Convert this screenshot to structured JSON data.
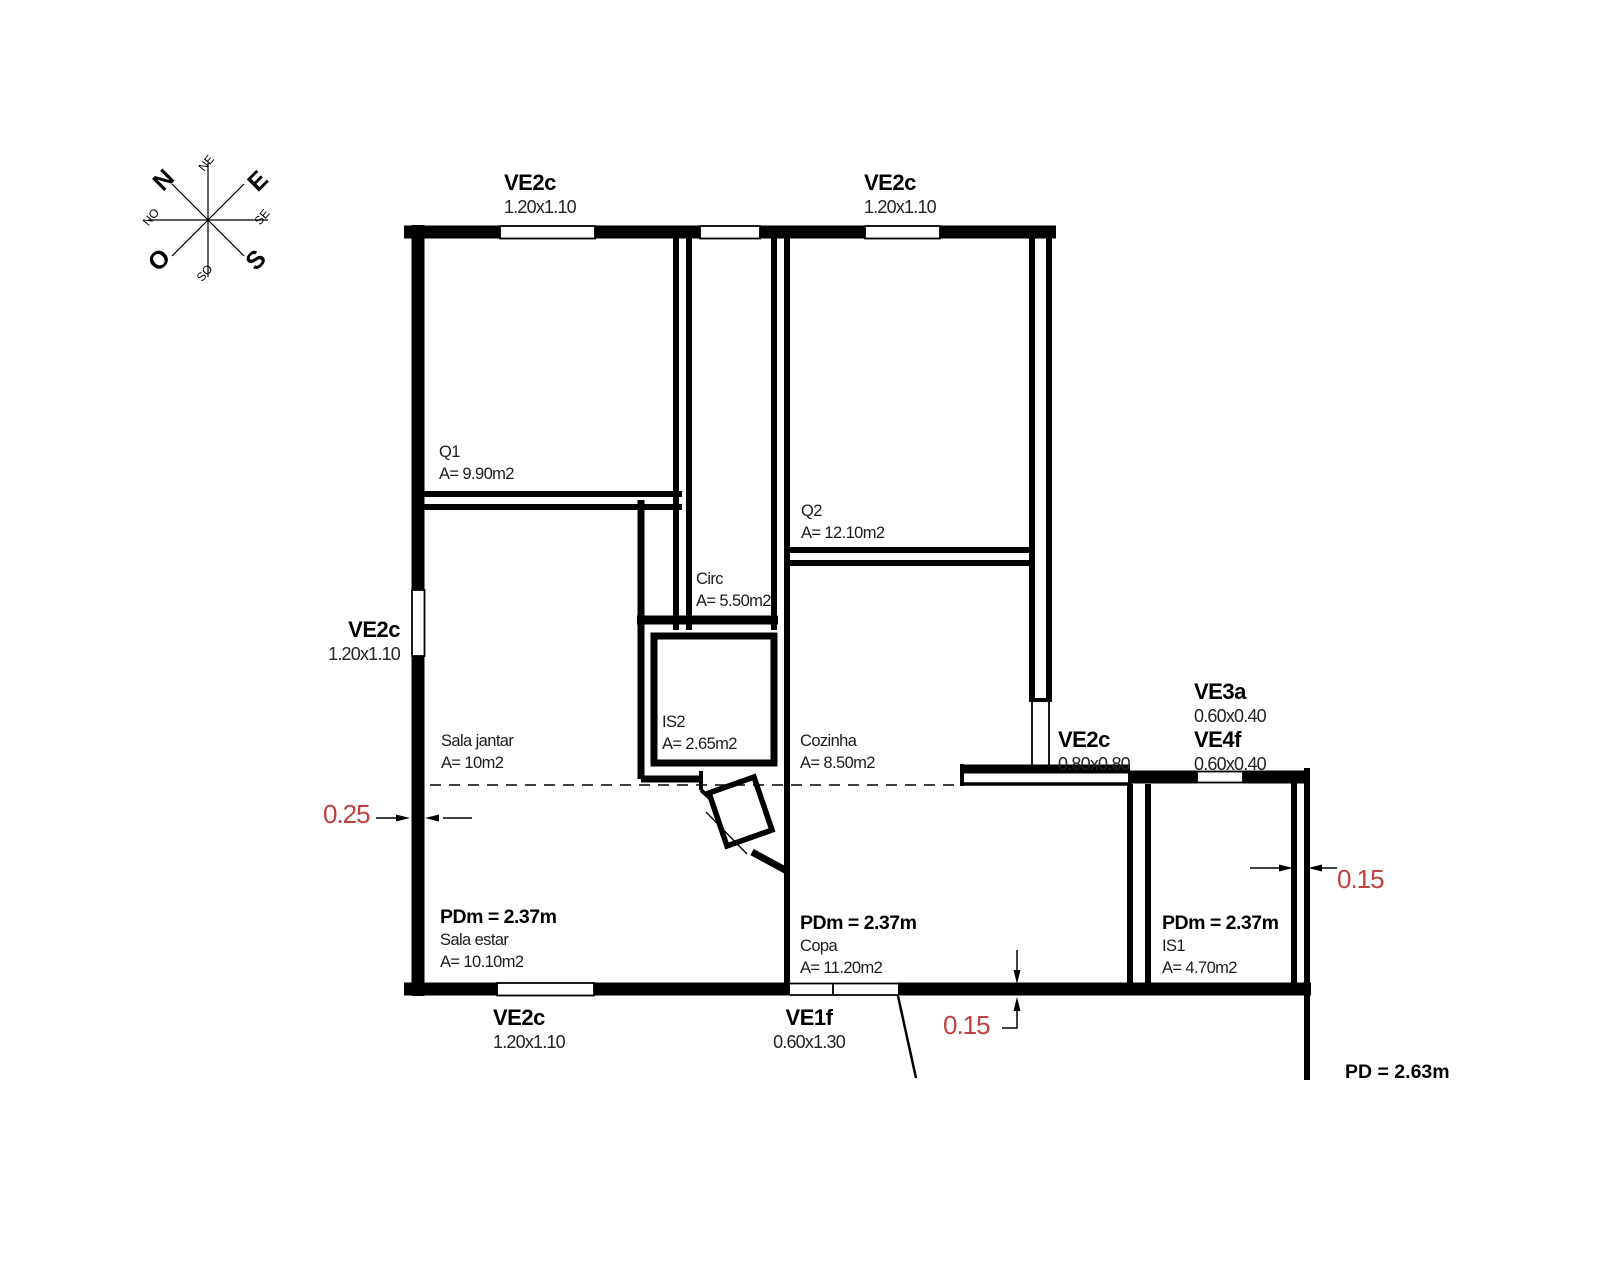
{
  "compass": {
    "n": "N",
    "e": "E",
    "o": "O",
    "s": "S",
    "ne": "NE",
    "se": "SE",
    "so": "SO",
    "no": "NO"
  },
  "openings": {
    "top_left": {
      "code": "VE2c",
      "size": "1.20x1.10"
    },
    "top_right": {
      "code": "VE2c",
      "size": "1.20x1.10"
    },
    "left": {
      "code": "VE2c",
      "size": "1.20x1.10"
    },
    "bottom": {
      "code": "VE2c",
      "size": "1.20x1.10"
    },
    "door_bottom": {
      "code": "VE1f",
      "size": "0.60x1.30"
    },
    "kitchen": {
      "code": "VE2c",
      "size": "0.80x0.80"
    },
    "ve3a": {
      "code": "VE3a",
      "size": "0.60x0.40"
    },
    "ve4f": {
      "code": "VE4f",
      "size": "0.60x0.40"
    }
  },
  "rooms": {
    "q1": {
      "name": "Q1",
      "area": "A= 9.90m2"
    },
    "q2": {
      "name": "Q2",
      "area": "A= 12.10m2"
    },
    "circ": {
      "name": "Circ",
      "area": "A= 5.50m2"
    },
    "is2": {
      "name": "IS2",
      "area": "A= 2.65m2"
    },
    "sala_jantar": {
      "name": "Sala jantar",
      "area": "A= 10m2"
    },
    "cozinha": {
      "name": "Cozinha",
      "area": "A= 8.50m2"
    },
    "sala_estar": {
      "ceiling": "PDm = 2.37m",
      "name": "Sala estar",
      "area": "A= 10.10m2"
    },
    "copa": {
      "ceiling": "PDm = 2.37m",
      "name": "Copa",
      "area": "A= 11.20m2"
    },
    "is1": {
      "ceiling": "PDm = 2.37m",
      "name": "IS1",
      "area": "A= 4.70m2"
    }
  },
  "dimensions": {
    "left_wall": "0.25",
    "right_wall": "0.15",
    "bottom_wall": "0.15",
    "ceiling_height": "PD = 2.63m"
  },
  "colors": {
    "dimension_text": "#c04040",
    "line": "#000000",
    "background": "#ffffff"
  }
}
